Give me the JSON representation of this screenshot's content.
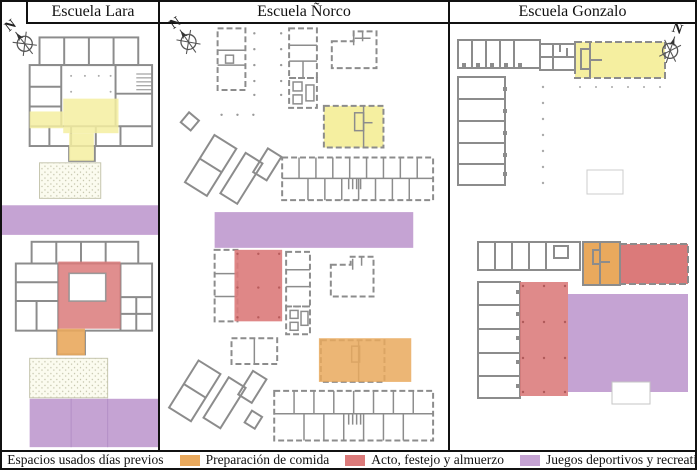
{
  "figure": {
    "kind": "school-site-plan-comparison",
    "panels": [
      {
        "title": "Escuela Lara",
        "compass_label": "N"
      },
      {
        "title": "Escuela Ñorco",
        "compass_label": "N"
      },
      {
        "title": "Escuela Gonzalo",
        "compass_label": "N"
      }
    ],
    "legend": {
      "items": [
        {
          "label": "Espacios usados días previos",
          "color": "#F5EFA0"
        },
        {
          "label": "Preparación de comida",
          "color": "#E9A95D"
        },
        {
          "label": "Acto, festejo y almuerzo",
          "color": "#DB7A7A"
        },
        {
          "label": "Juegos deportivos y recreativos",
          "color": "#C5A3D3"
        }
      ]
    },
    "colors": {
      "previous_days": "#F5EFA0",
      "food_preparation": "#E9A95D",
      "event_lunch": "#DB7A7A",
      "sports_games": "#C5A3D3",
      "plan_walls": "#8C8C8C",
      "panel_border": "#111111"
    }
  }
}
